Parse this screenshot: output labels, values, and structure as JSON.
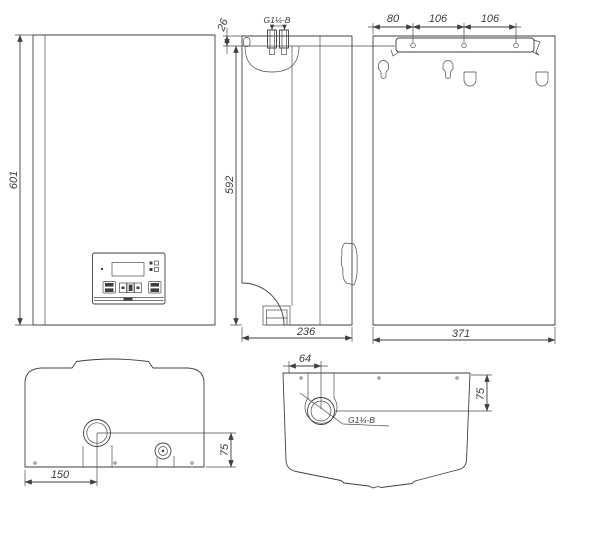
{
  "figure": {
    "type": "technical-drawing",
    "background": "#ffffff",
    "line_color": "#3f3f3f",
    "views": {
      "front": {
        "height": "601"
      },
      "side": {
        "top_offset": "26",
        "connection": "G1¼-B",
        "height": "592",
        "depth": "236"
      },
      "back": {
        "spacings": [
          "80",
          "106",
          "106"
        ],
        "width": "371"
      },
      "bottom": {
        "pipe_offset_x": "150",
        "pipe_offset_y": "75"
      },
      "top": {
        "pipe_offset_x": "64",
        "connection": "G1¼-B",
        "pipe_offset_y": "75"
      }
    }
  }
}
